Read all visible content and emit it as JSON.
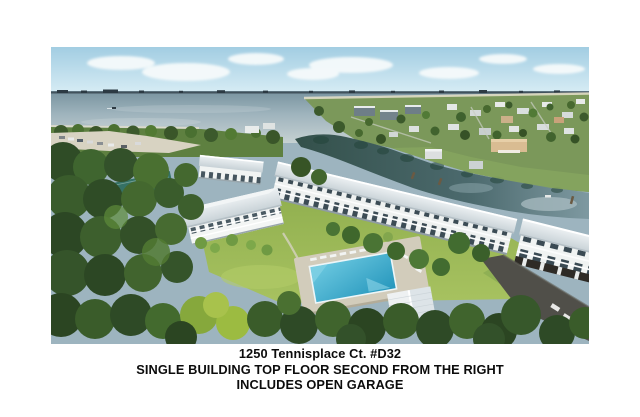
{
  "caption": {
    "address": "1250 Tennisplace Ct. #D32",
    "line2": "SINGLE BUILDING TOP FLOOR SECOND FROM THE RIGHT",
    "line3": "INCLUDES OPEN GARAGE"
  },
  "photo": {
    "subject": "aerial-view-of-waterfront-condo-community",
    "palette": {
      "page_background": "#ffffff",
      "sky": "#aed5e8",
      "cloud": "#f6fafb",
      "bay_water": "#8aa3b2",
      "causeway": "#3c4b55",
      "canal_water": "#3a564f",
      "foliage_dark": "#2e4a26",
      "foliage_light": "#9cbb41",
      "lawn": "#93b254",
      "sand_parking": "#d8d3c2",
      "building_wall": "#f3f5f4",
      "building_roof": "#dde3e6",
      "window": "#3c4c55",
      "pool": "#3fb0d5",
      "pool_deck": "#d2ccbb",
      "asphalt": "#504f49",
      "caption_text": "#0c0c0c"
    }
  }
}
